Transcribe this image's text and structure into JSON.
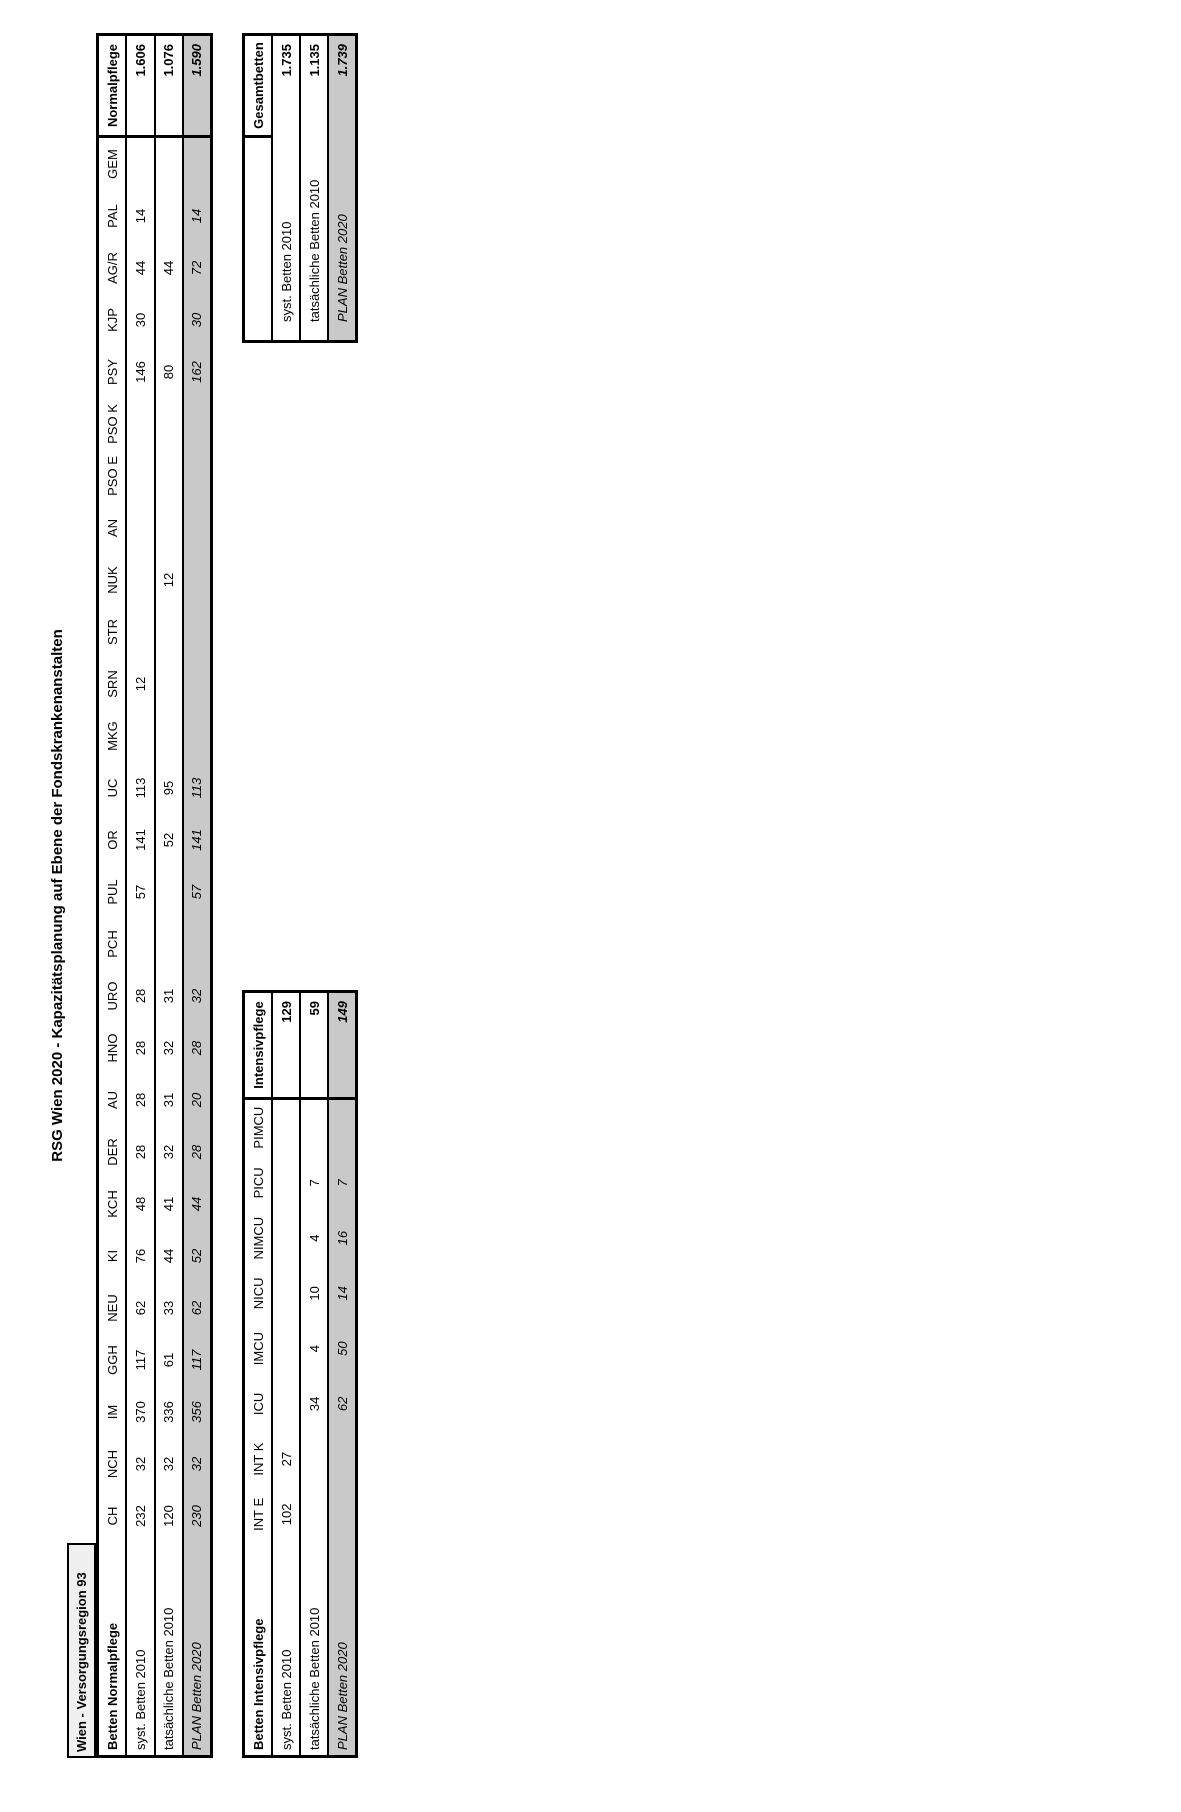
{
  "title": "RSG Wien 2020 - Kapazitätsplanung auf Ebene der Fondskrankenanstalten",
  "region_header": "Wien - Versorgungsregion 93",
  "colors": {
    "plan_row_bg": "#c9c9c9",
    "region_box_bg": "#f0f0f0",
    "border": "#000000"
  },
  "normal_table": {
    "corner_label": "Betten Normalpflege",
    "total_label": "Normalpflege",
    "columns": [
      "CH",
      "NCH",
      "IM",
      "GGH",
      "NEU",
      "KI",
      "KCH",
      "DER",
      "AU",
      "HNO",
      "URO",
      "PCH",
      "PUL",
      "OR",
      "UC",
      "MKG",
      "SRN",
      "STR",
      "NUK",
      "AN",
      "PSO E",
      "PSO K",
      "PSY",
      "KJP",
      "AG/R",
      "PAL",
      "GEM"
    ],
    "rows": [
      {
        "label": "syst. Betten 2010",
        "emphasis": "normal",
        "values": [
          "232",
          "32",
          "370",
          "117",
          "62",
          "76",
          "48",
          "28",
          "28",
          "28",
          "28",
          "",
          "57",
          "141",
          "113",
          "",
          "12",
          "",
          "",
          "",
          "",
          "",
          "146",
          "30",
          "44",
          "14",
          ""
        ],
        "total": "1.606"
      },
      {
        "label": "tatsächliche Betten 2010",
        "emphasis": "normal",
        "values": [
          "120",
          "32",
          "336",
          "61",
          "33",
          "44",
          "41",
          "32",
          "31",
          "32",
          "31",
          "",
          "",
          "52",
          "95",
          "",
          "",
          "",
          "12",
          "",
          "",
          "",
          "80",
          "",
          "44",
          "",
          ""
        ],
        "total": "1.076"
      },
      {
        "label": "PLAN Betten 2020",
        "emphasis": "plan",
        "values": [
          "230",
          "32",
          "356",
          "117",
          "62",
          "52",
          "44",
          "28",
          "20",
          "28",
          "32",
          "",
          "57",
          "141",
          "113",
          "",
          "",
          "",
          "",
          "",
          "",
          "",
          "162",
          "30",
          "72",
          "14",
          ""
        ],
        "total": "1.590"
      }
    ]
  },
  "intensive_table": {
    "corner_label": "Betten Intensivpflege",
    "total_label": "Intensivpflege",
    "columns": [
      "INT E",
      "INT K",
      "ICU",
      "IMCU",
      "NICU",
      "NIMCU",
      "PICU",
      "PIMCU"
    ],
    "rows": [
      {
        "label": "syst. Betten 2010",
        "emphasis": "normal",
        "values": [
          "102",
          "27",
          "",
          "",
          "",
          "",
          "",
          ""
        ],
        "total": "129"
      },
      {
        "label": "tatsächliche Betten 2010",
        "emphasis": "normal",
        "values": [
          "",
          "",
          "34",
          "4",
          "10",
          "4",
          "7",
          ""
        ],
        "total": "59"
      },
      {
        "label": "PLAN Betten 2020",
        "emphasis": "plan",
        "values": [
          "",
          "",
          "62",
          "50",
          "14",
          "16",
          "7",
          ""
        ],
        "total": "149"
      }
    ]
  },
  "total_table": {
    "corner_label": "",
    "total_label": "Gesamtbetten",
    "rows": [
      {
        "label": "syst. Betten 2010",
        "emphasis": "normal",
        "total": "1.735"
      },
      {
        "label": "tatsächliche Betten 2010",
        "emphasis": "normal",
        "total": "1.135"
      },
      {
        "label": "PLAN Betten 2020",
        "emphasis": "plan",
        "total": "1.739"
      }
    ]
  }
}
